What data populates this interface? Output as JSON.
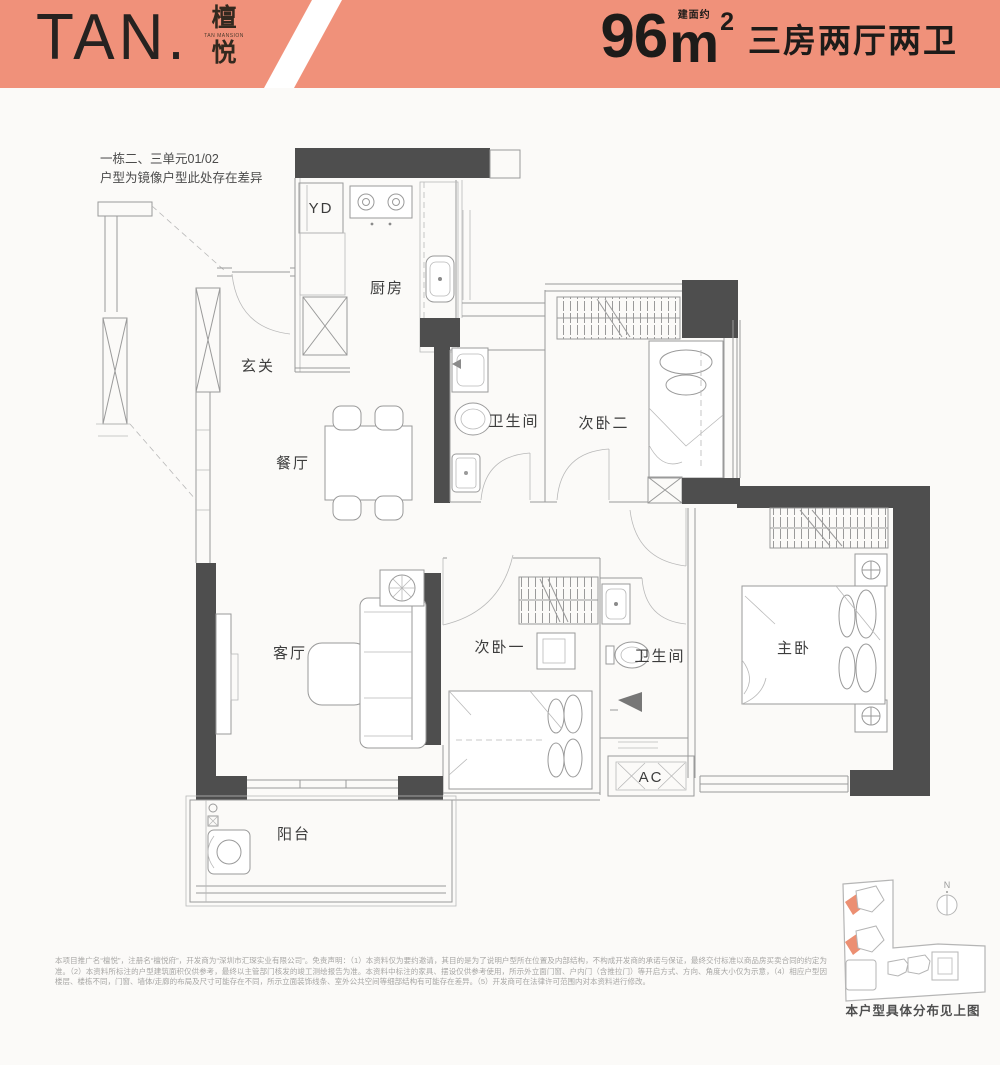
{
  "header": {
    "bg_color": "#F0917A",
    "logo_text": "TAN.",
    "logo_cn_top": "檀",
    "logo_cn_sub": "TAN MANSION",
    "logo_cn_bottom": "悦",
    "area_prefix": "建面约",
    "area_value": "96",
    "area_unit": "m",
    "area_sup": "2",
    "layout_desc": "三房两厅两卫",
    "text_color": "#1d1b19"
  },
  "note": {
    "line1": "一栋二、三单元01/02",
    "line2": "户型为镜像户型此处存在差异"
  },
  "plan": {
    "rooms": {
      "yd": "YD",
      "kitchen": "厨房",
      "entry": "玄关",
      "dining": "餐厅",
      "bath1": "卫生间",
      "bedroom2": "次卧二",
      "living": "客厅",
      "bedroom1": "次卧一",
      "bath2": "卫生间",
      "master": "主卧",
      "balcony": "阳台",
      "ac": "AC"
    },
    "wall_color": "#4e4e4e",
    "line_color": "#9a9a9a"
  },
  "sitemap": {
    "compass_label": "N",
    "caption": "本户型具体分布见上图",
    "accent_color": "#EC8F72"
  },
  "disclaimer": {
    "text": "本项目推广名“檀悦”，注册名“檀悦府”，开发商为“深圳市汇琛实业有限公司”。免责声明：（1）本资料仅为要约邀请，其目的是为了说明户型所在位置及内部结构，不构成开发商的承诺与保证，最终交付标准以商品房买卖合同的约定为准。（2）本资料所标注的户型建筑面积仅供参考，最终以主管部门核发的竣工测绘报告为准。本资料中标注的家具、摆设仅供参考使用，所示外立面门窗、户内门（含推拉门）等开启方式、方向、角度大小仅为示意，（4）相应户型因楼层、楼栋不同，门窗、墙体/走廊的布局及尺寸可能存在不同，所示立面装饰线条、室外公共空间等细部结构有可能存在差异。（5）开发商可在法律许可范围内对本资料进行修改。"
  }
}
